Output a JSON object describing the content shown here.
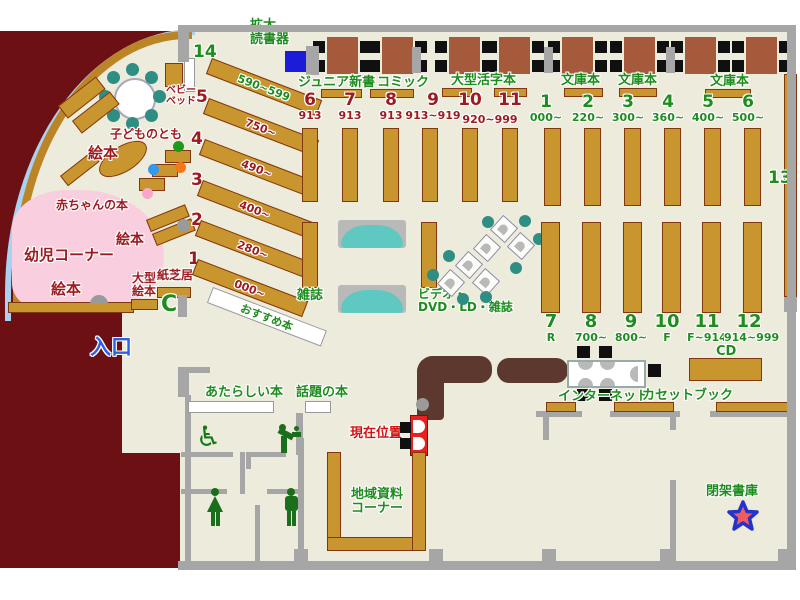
{
  "labels": {
    "kakudai1": "拡大",
    "kakudai2": "読書器",
    "junior": "ジュニア新書",
    "comic": "コミック",
    "large_print": "大型活字本",
    "bunko1": "文庫本",
    "bunko2": "文庫本",
    "bunko3": "文庫本",
    "magazine": "雑誌",
    "video1": "ビデオ・",
    "video2": "DVD・LD・雑誌",
    "recommend": "おすすめ本",
    "new_books": "あたらしい本",
    "topic_books": "話題の本",
    "internet": "インターネット",
    "cassette": "カセットブック",
    "cd": "CD",
    "local1": "地域資料",
    "local2": "コーナー",
    "closed_stack": "閉架書庫",
    "current": "現在位置",
    "entrance": "入口",
    "picture_left": "絵本",
    "picture_mid": "絵本",
    "picture_bottom": "絵本",
    "kodomo": "子どものとも",
    "baby_books": "赤ちゃんの本",
    "toddler": "幼児コーナー",
    "large_pic1": "大型",
    "large_pic2": "絵本",
    "kamishibai": "紙芝居",
    "baby1": "ベビー",
    "baby2": "ベッド"
  },
  "icons": {
    "wheelchair": "♿",
    "gate": "C"
  },
  "diagonal": [
    {
      "no": "14",
      "range": "590~599"
    },
    {
      "no": "5",
      "range": "750~"
    },
    {
      "no": "4",
      "range": "490~"
    },
    {
      "no": "3",
      "range": "400~"
    },
    {
      "no": "2",
      "range": "280~"
    },
    {
      "no": "1",
      "range": "000~"
    }
  ],
  "upper_mid": [
    {
      "no": "6",
      "range": "913"
    },
    {
      "no": "7",
      "range": "913"
    },
    {
      "no": "8",
      "range": "913"
    },
    {
      "no": "9",
      "range": "913~919"
    },
    {
      "no": "10",
      "range": ""
    },
    {
      "no": "11",
      "range": ""
    }
  ],
  "upper_mid_shared_range": "920~999",
  "upper_right": [
    {
      "no": "1",
      "range": "000~"
    },
    {
      "no": "2",
      "range": "220~"
    },
    {
      "no": "3",
      "range": "300~"
    },
    {
      "no": "4",
      "range": "360~"
    },
    {
      "no": "5",
      "range": "400~"
    },
    {
      "no": "6",
      "range": "500~"
    }
  ],
  "lower_right": [
    {
      "no": "7",
      "range": "R"
    },
    {
      "no": "8",
      "range": "700~"
    },
    {
      "no": "9",
      "range": "800~"
    },
    {
      "no": "10",
      "range": "F"
    },
    {
      "no": "11",
      "range": "F~914"
    },
    {
      "no": "12",
      "range": "914~999"
    }
  ],
  "tall_shelf": "13",
  "colors": {
    "floor": "#edebdc",
    "outside": "#6d1013",
    "shelf": "#c9952f",
    "accent_green": "#1e8c1e",
    "accent_red": "#9c1b20",
    "pink": "#f9cede",
    "blue_line": "#a9d1f2",
    "counter": "#5d382e",
    "teal": "#5fc8c0"
  }
}
